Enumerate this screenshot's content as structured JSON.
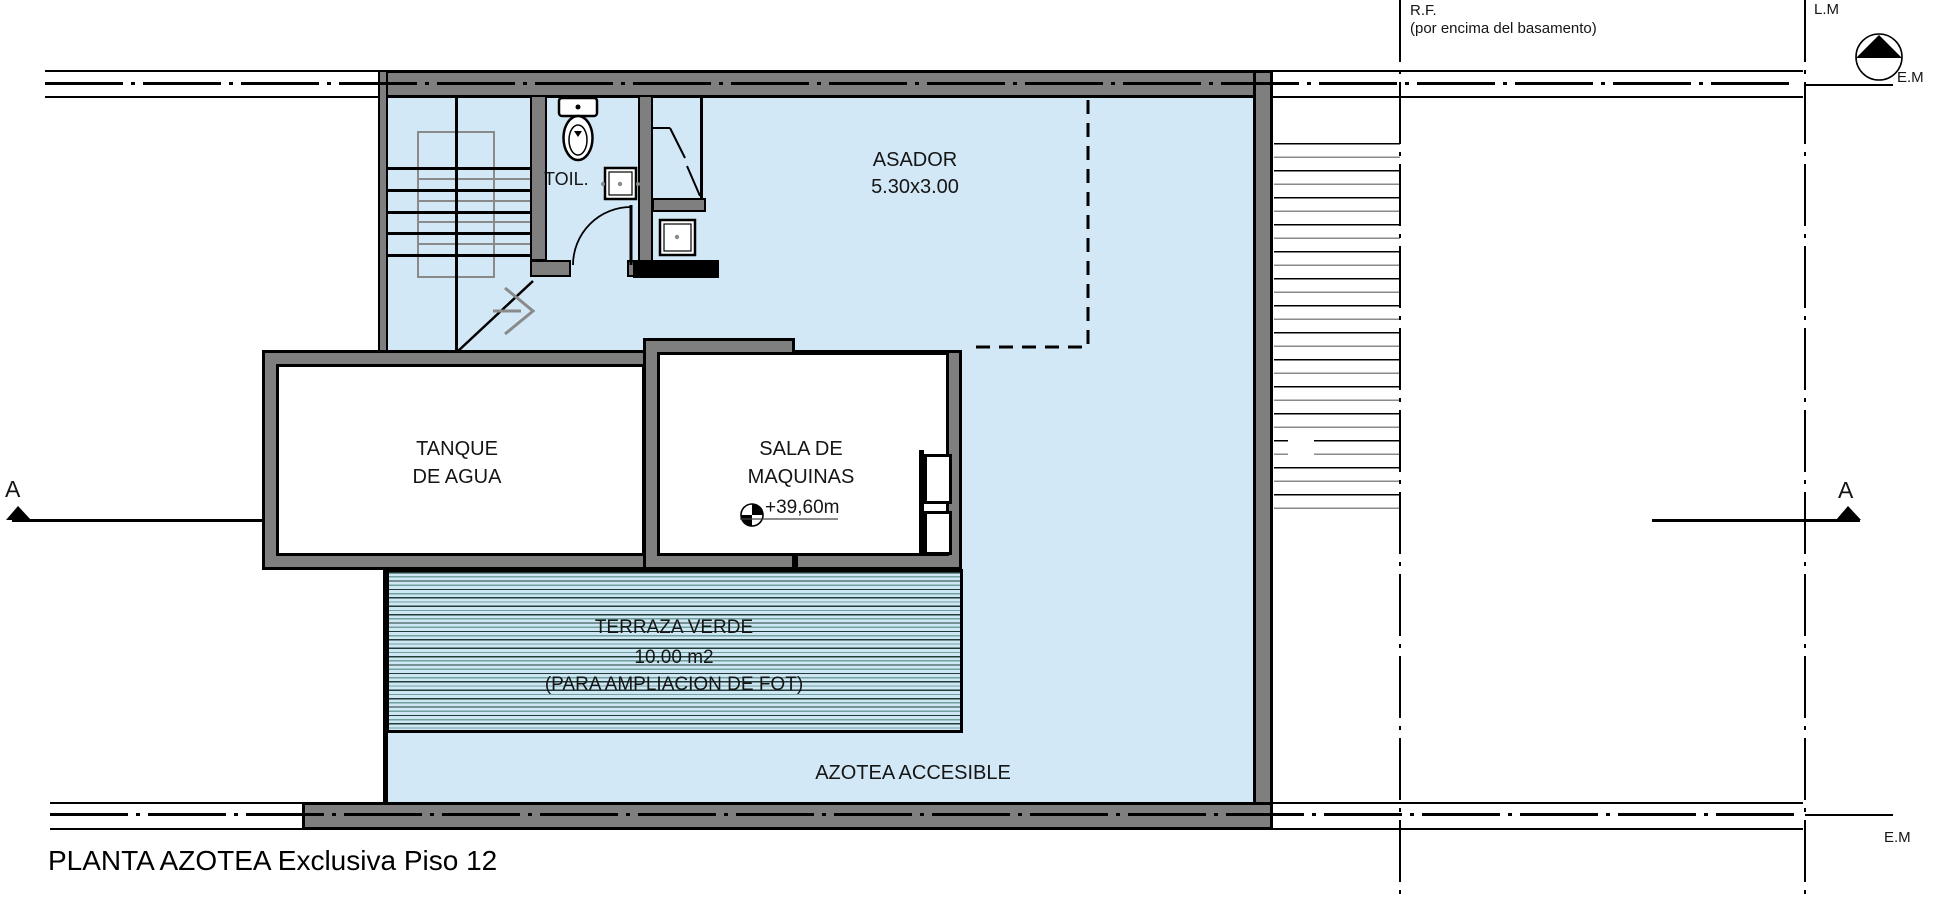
{
  "title": "PLANTA AZOTEA Exclusiva Piso 12",
  "rooms": {
    "toilet": "TOIL.",
    "asador_name": "ASADOR",
    "asador_size": "5.30x3.00",
    "tanque_line1": "TANQUE",
    "tanque_line2": "DE AGUA",
    "sala_line1": "SALA DE",
    "sala_line2": "MAQUINAS",
    "terraza_line1": "TERRAZA VERDE",
    "terraza_line2": "10.00 m2",
    "terraza_line3": "(PARA AMPLIACION DE FOT)",
    "azotea": "AZOTEA ACCESIBLE"
  },
  "annotations": {
    "level_mark": "+39,60m",
    "rf_line1": "R.F.",
    "rf_line2": "(por encima del basamento)",
    "lm": "L.M",
    "em_top": "E.M",
    "em_bottom": "E.M",
    "section_left": "A",
    "section_right": "A"
  },
  "colors": {
    "plan_fill_blue": "#d2e8f6",
    "wall_gray": "#7f7f7f",
    "line_black": "#000000",
    "terraza_stripe_green": "#2e6b57"
  }
}
